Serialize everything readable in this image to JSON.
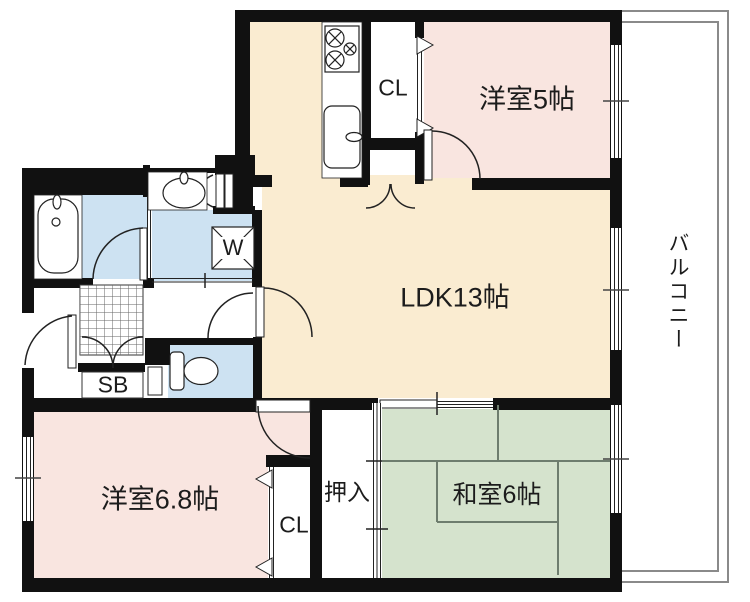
{
  "floorplan": {
    "rooms": {
      "western_room_5": {
        "label": "洋室5帖"
      },
      "ldk": {
        "label": "LDK13帖"
      },
      "balcony": {
        "label": "バルコニー"
      },
      "western_room_68": {
        "label": "洋室6.8帖"
      },
      "japanese_room_6": {
        "label": "和室6帖"
      },
      "oshiire": {
        "label": "押入"
      },
      "closet_upper": {
        "label": "CL"
      },
      "closet_lower": {
        "label": "CL"
      },
      "shoe_box": {
        "label": "SB"
      },
      "washing_machine": {
        "label": "W"
      }
    },
    "colors": {
      "western_room_fill": "#f9e5e0",
      "ldk_fill": "#faecd1",
      "japanese_room_fill": "#d5e3cd",
      "wet_area_fill": "#cde2f2",
      "wall": "#111111",
      "balcony_line": "#8a8a8a"
    }
  }
}
